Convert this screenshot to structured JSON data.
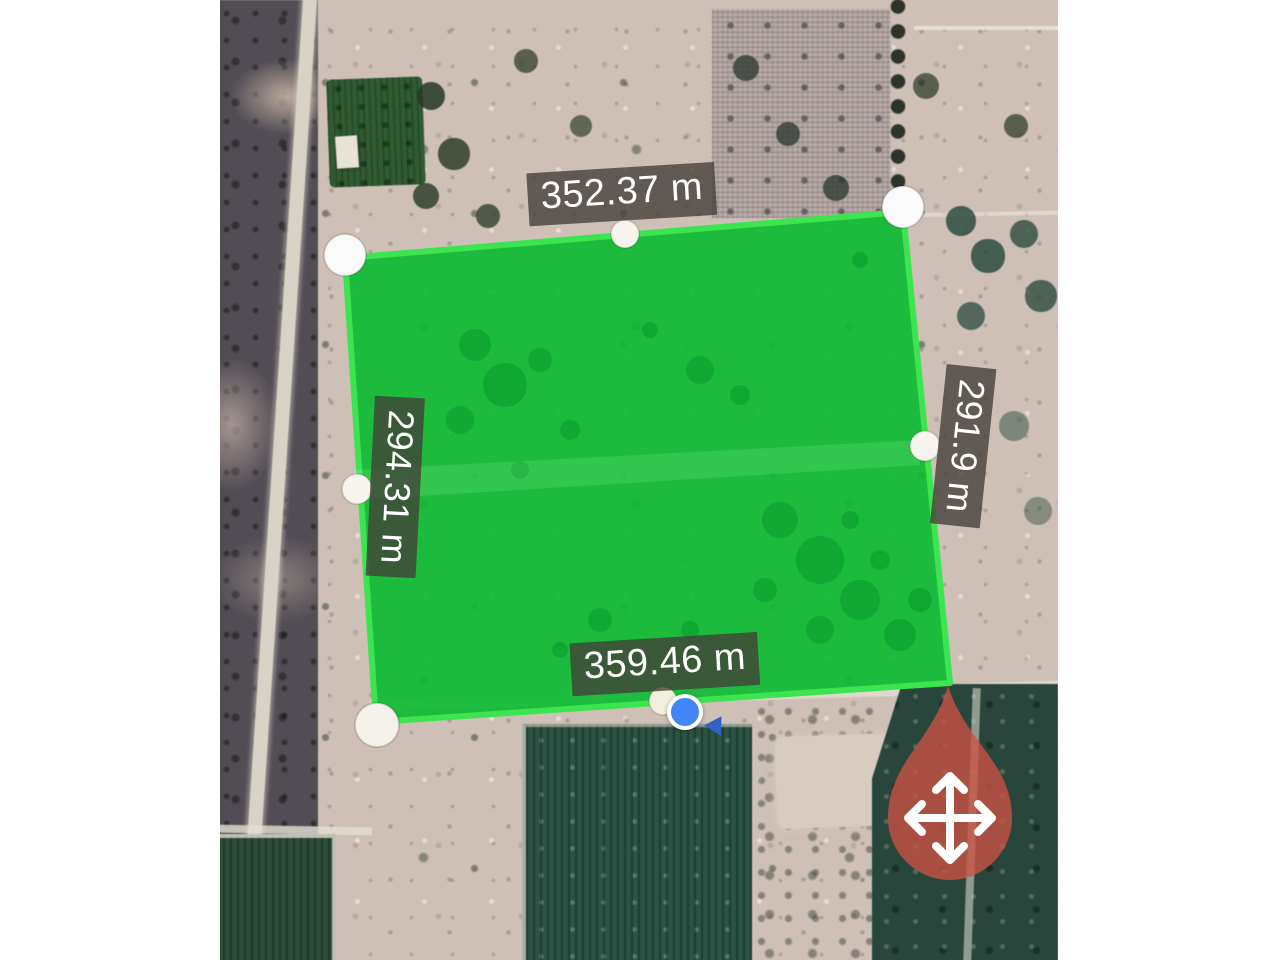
{
  "app": {
    "view": "satellite-area-measurement",
    "map_type": "satellite"
  },
  "measurements": {
    "top": "352.37 m",
    "left": "294.31 m",
    "right": "291.9 m",
    "bottom": "359.46 m"
  },
  "polygon": {
    "vertex_count": 4,
    "fill_color": "#0dbb34",
    "stroke_color": "#3ce450",
    "handle_color": "#ffffff"
  },
  "markers": {
    "move_marker": {
      "icon": "move-icon",
      "color": "#cd5242"
    },
    "location_dot": {
      "icon": "location-dot-icon",
      "color": "#4285f4"
    },
    "heading_arrow": {
      "icon": "direction-arrow-icon",
      "color": "#2f62c4"
    }
  },
  "label_style": {
    "background": "rgba(66,62,56,0.78)",
    "text_color": "#ffffff"
  }
}
